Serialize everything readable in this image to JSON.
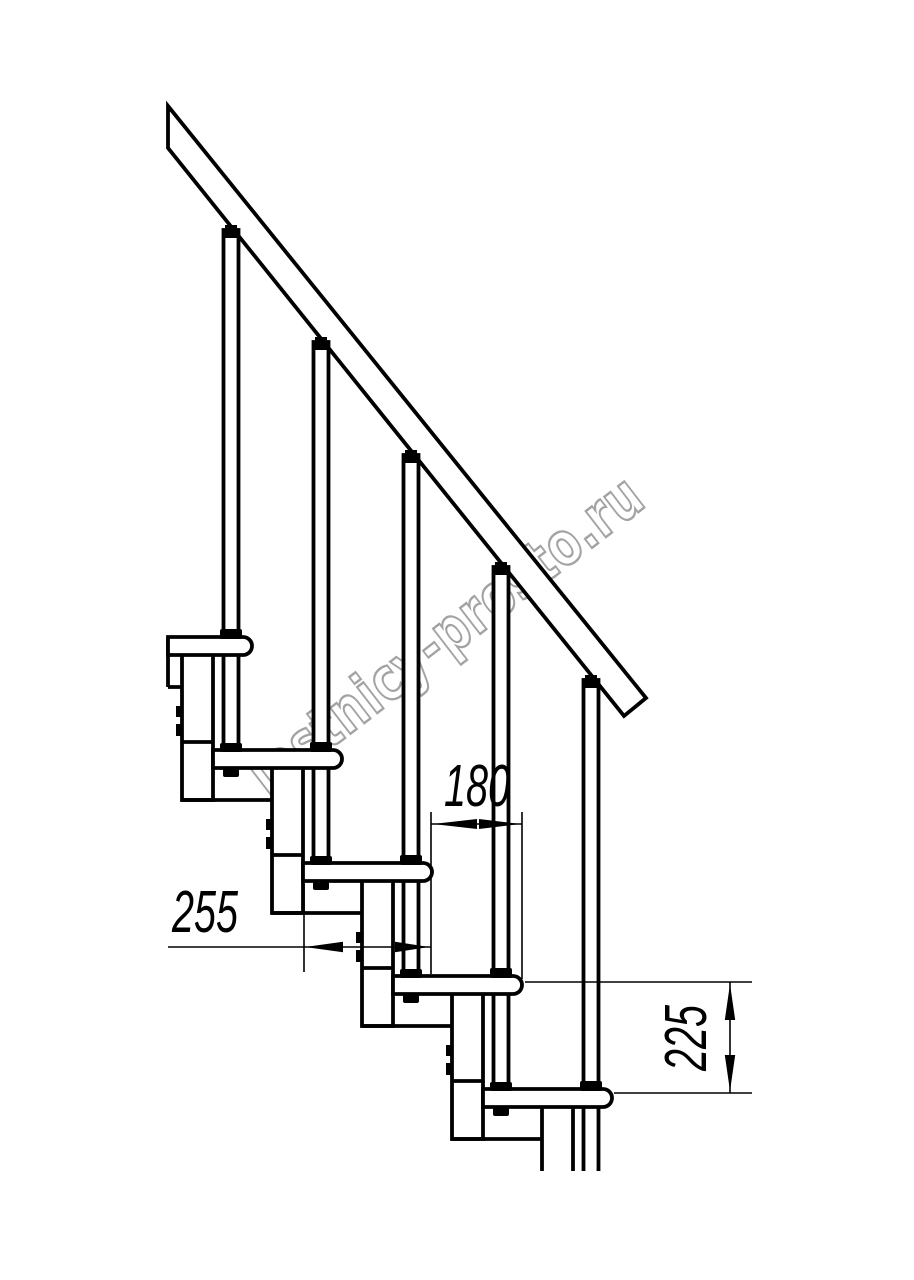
{
  "drawing": {
    "watermark": "lestnicy-prosto.ru",
    "dimensions": {
      "step_run": "180",
      "tread_depth": "255",
      "step_height": "225"
    },
    "colors": {
      "line": "#000000",
      "background": "#ffffff",
      "watermark_outline": "#a3a3a3",
      "watermark_fill": "#ffffff"
    }
  }
}
